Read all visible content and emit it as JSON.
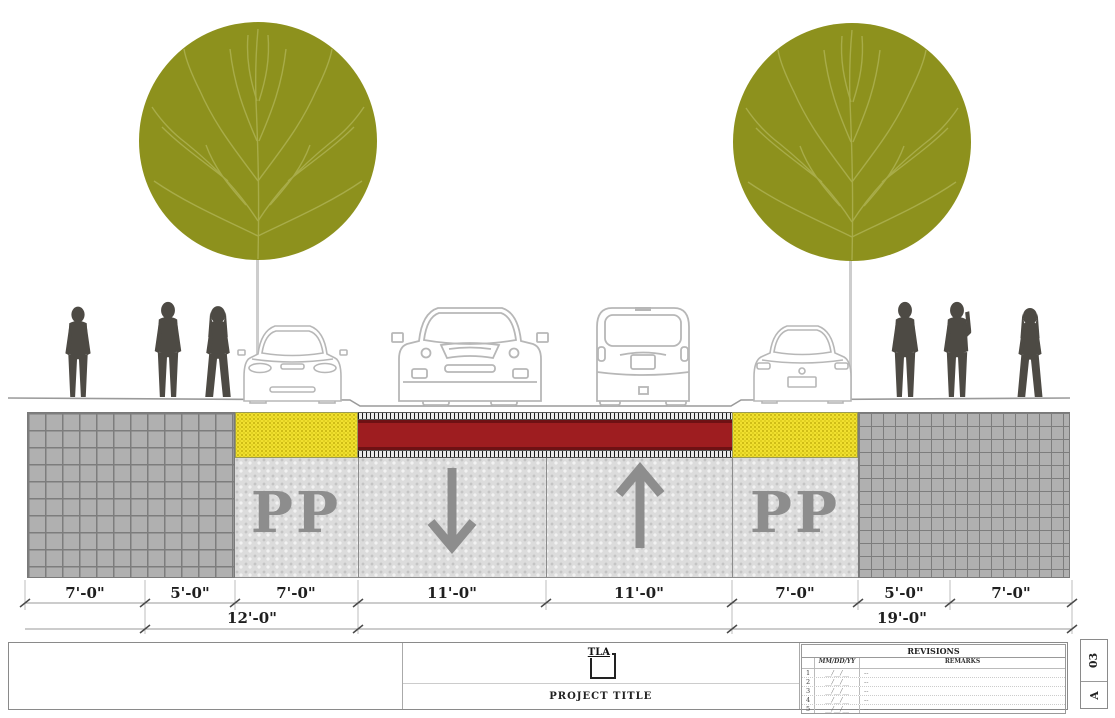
{
  "section": {
    "parking_label_left": "PP",
    "parking_label_right": "PP",
    "lane_left_direction": "down-arrow",
    "lane_right_direction": "up-arrow"
  },
  "dims": {
    "row1": [
      "7'-0\"",
      "5'-0\"",
      "7'-0\"",
      "11'-0\"",
      "11'-0\"",
      "7'-0\"",
      "5'-0\"",
      "7'-0\""
    ],
    "row2": [
      "12'-0\"",
      "19'-0\""
    ]
  },
  "title_block": {
    "logo": "TLA",
    "project_title": "PROJECT TITLE",
    "revisions_title": "REVISIONS",
    "col_date": "MM/DD/YY",
    "col_remarks": "REMARKS",
    "rows": [
      {
        "num": "1",
        "date": "__/__/__",
        "remarks": "--"
      },
      {
        "num": "2",
        "date": "__/__/__",
        "remarks": "--"
      },
      {
        "num": "3",
        "date": "__/__/__",
        "remarks": "--"
      },
      {
        "num": "4",
        "date": "__/__/__",
        "remarks": "--"
      },
      {
        "num": "5",
        "date": "__/__/__",
        "remarks": "--"
      }
    ],
    "sheet_number": "03",
    "revision_letter": "A"
  },
  "colors": {
    "tree_canopy": "#8d911d",
    "tree_branches": "#a8ac49",
    "yellow_zone": "#f2e130",
    "red_band": "#9e1d20",
    "sidewalk_grid": "#b0b0b0",
    "lane_stipple": "#dcdcdc",
    "silhouette": "#4d4a44",
    "lane_label_gray": "#8d8d8d"
  }
}
